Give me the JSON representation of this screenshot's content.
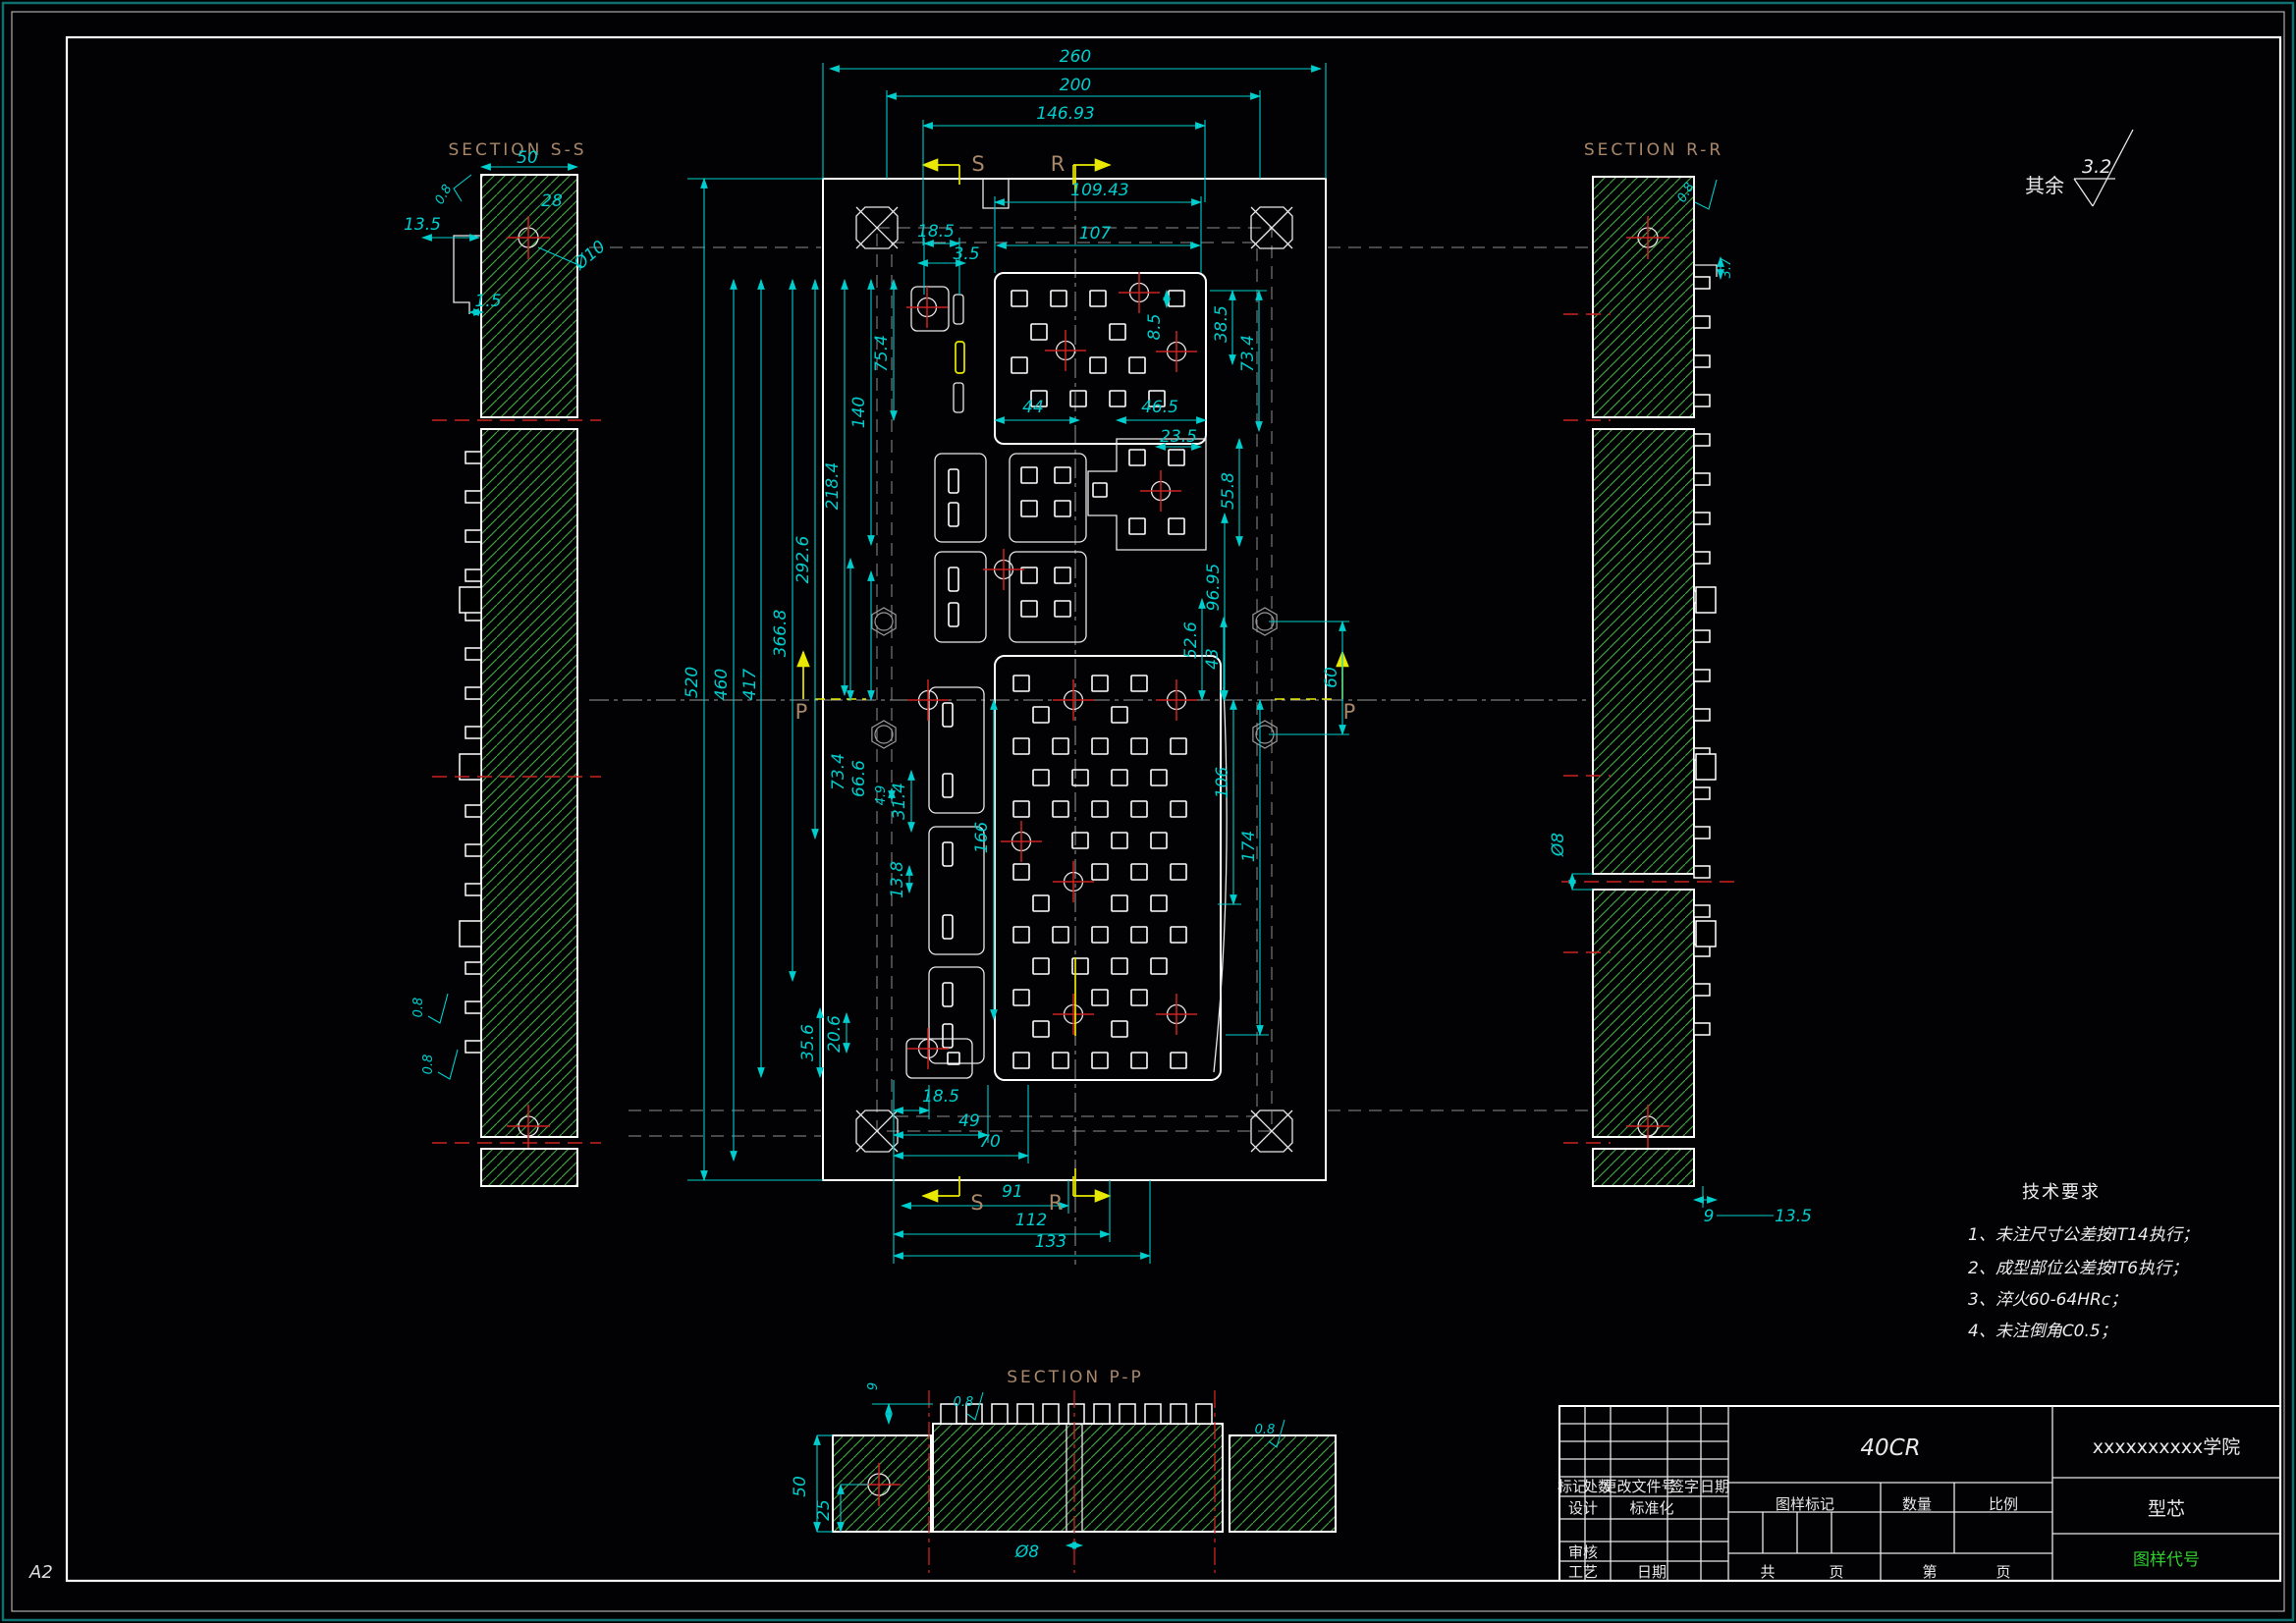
{
  "sheet": {
    "format": "A2",
    "roughness_note_prefix": "其余",
    "roughness_note_value": "3.2"
  },
  "sections": {
    "ss": {
      "title": "SECTION S-S",
      "dims": [
        "50",
        "0.8",
        "28",
        "13.5",
        "Ø10",
        "1.5",
        "0.8",
        "0.8"
      ]
    },
    "rr": {
      "title": "SECTION R-R",
      "dims": [
        "0.8",
        "3.7",
        "Ø8",
        "9",
        "13.5"
      ]
    },
    "pp": {
      "title": "SECTION P-P",
      "dims": [
        "9",
        "0.8",
        "0.8",
        "50",
        "25",
        "Ø8"
      ]
    }
  },
  "main_view": {
    "top_dims": [
      "260",
      "200",
      "146.93",
      "109.43",
      "107",
      "18.5",
      "3.5"
    ],
    "left_dims": [
      "520",
      "460",
      "417",
      "366.8",
      "292.6",
      "218.4",
      "140",
      "75.4"
    ],
    "mid_left_dims": [
      "73.4",
      "66.6",
      "4.9",
      "31.4",
      "166",
      "13.8",
      "20.6",
      "35.6"
    ],
    "mid_dims": [
      "44",
      "46.5",
      "23.5"
    ],
    "right_dims": [
      "8.5",
      "38.5",
      "73.4",
      "55.8",
      "96.95",
      "52.6",
      "43",
      "60",
      "106",
      "174"
    ],
    "bottom_dims": [
      "18.5",
      "49",
      "70",
      "91",
      "112",
      "133"
    ],
    "cut_labels": {
      "s": "S",
      "r": "R",
      "p": "P"
    }
  },
  "tech_requirements": {
    "title": "技术要求",
    "items": [
      "1、未注尺寸公差按IT14执行；",
      "2、成型部位公差按IT6执行；",
      "3、淬火60-64HRc；",
      "4、未注倒角C0.5；"
    ]
  },
  "title_block": {
    "material": "40CR",
    "company": "xxxxxxxxxx学院",
    "part_name": "型芯",
    "drawing_code": "图样代号",
    "rev_headers": [
      "标记",
      "处数",
      "更改文件号",
      "签字",
      "日期"
    ],
    "roles": {
      "design": "设计",
      "standardize": "标准化",
      "review": "审核",
      "process": "工艺",
      "date": "日期"
    },
    "mark_headers": [
      "图样标记",
      "数量",
      "比例"
    ],
    "page": {
      "total_label": "共",
      "page_label": "页",
      "no_label": "第",
      "page_label2": "页"
    }
  },
  "colors": {
    "dimension": "#00cdcd",
    "hatch_green": "#3f9e3f",
    "centerline_red": "#cc2222",
    "cutline_yellow": "#e8e800",
    "section_label_brown": "#a8876a",
    "drawing_code_green": "#2fd12f",
    "outline_white": "#ffffff",
    "frame_teal": "#0f6f6f"
  }
}
